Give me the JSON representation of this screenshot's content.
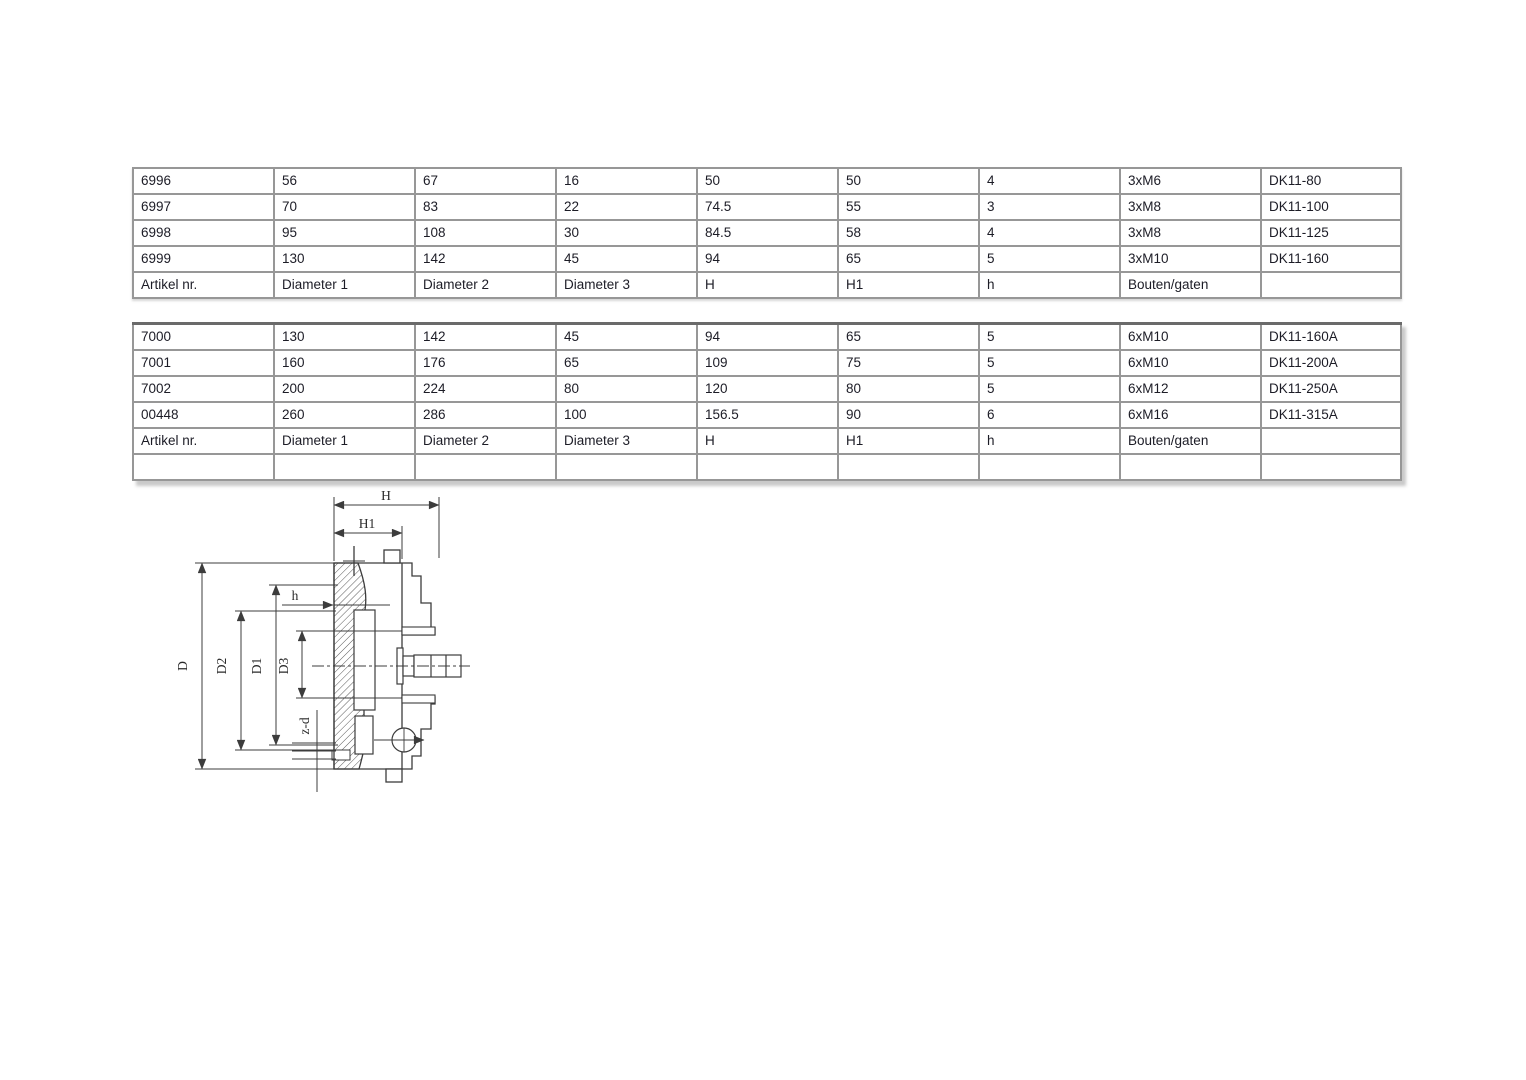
{
  "colors": {
    "background": "#ffffff",
    "table_text": "#1c1c26",
    "grid_line": "#979797",
    "outer_border": "#6a6a6a",
    "drawing_line": "#3c3c3c"
  },
  "table1": {
    "rows": [
      [
        "6996",
        "56",
        "67",
        "16",
        "50",
        "50",
        "4",
        "3xM6",
        "DK11-80"
      ],
      [
        "6997",
        "70",
        "83",
        "22",
        "74.5",
        "55",
        "3",
        "3xM8",
        "DK11-100"
      ],
      [
        "6998",
        "95",
        "108",
        "30",
        "84.5",
        "58",
        "4",
        "3xM8",
        "DK11-125"
      ],
      [
        "6999",
        "130",
        "142",
        "45",
        "94",
        "65",
        "5",
        "3xM10",
        "DK11-160"
      ],
      [
        "Artikel nr.",
        "Diameter 1",
        "Diameter 2",
        "Diameter 3",
        "H",
        "H1",
        "h",
        "Bouten/gaten",
        ""
      ]
    ]
  },
  "table2": {
    "rows": [
      [
        "7000",
        "130",
        "142",
        "45",
        "94",
        "65",
        "5",
        "6xM10",
        "DK11-160A"
      ],
      [
        "7001",
        "160",
        "176",
        "65",
        "109",
        "75",
        "5",
        "6xM10",
        "DK11-200A"
      ],
      [
        "7002",
        "200",
        "224",
        "80",
        "120",
        "80",
        "5",
        "6xM12",
        "DK11-250A"
      ],
      [
        "00448",
        "260",
        "286",
        "100",
        "156.5",
        "90",
        "6",
        "6xM16",
        "DK11-315A"
      ],
      [
        "Artikel nr.",
        "Diameter 1",
        "Diameter 2",
        "Diameter 3",
        "H",
        "H1",
        "h",
        "Bouten/gaten",
        ""
      ],
      [
        "",
        "",
        "",
        "",
        "",
        "",
        "",
        "",
        ""
      ]
    ]
  },
  "diagram": {
    "labels": {
      "H": "H",
      "H1": "H1",
      "h": "h",
      "D": "D",
      "D1": "D1",
      "D2": "D2",
      "D3": "D3",
      "zd": "z-d"
    }
  }
}
